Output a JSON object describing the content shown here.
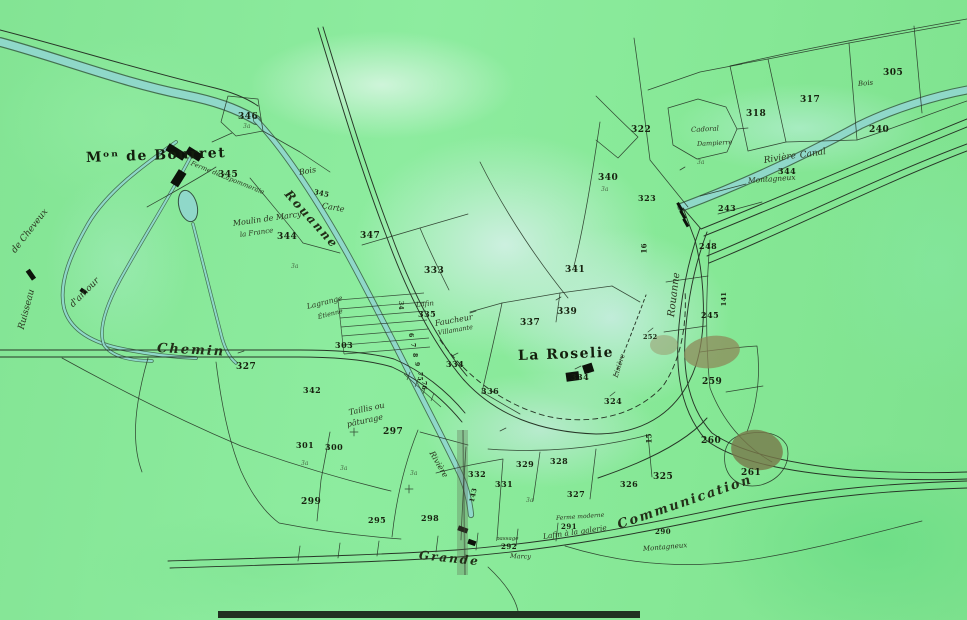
{
  "palette": {
    "paper_green": "#86e798",
    "wash_cyan": "#cfeee4",
    "river_teal": "#8fd8c9",
    "ink": "#273627",
    "building_black": "#0d120b",
    "smudge_brown": "#8d8758"
  },
  "labels": [
    {
      "t": "Mᵒⁿ de Bourret",
      "x": 86,
      "y": 151,
      "s": 14,
      "r": -2,
      "c": "t"
    },
    {
      "t": "La Roselie",
      "x": 518,
      "y": 349,
      "s": 14,
      "r": -2,
      "c": "t"
    },
    {
      "t": "Chemin",
      "x": 157,
      "y": 342,
      "s": 13,
      "r": 3,
      "c": "sl"
    },
    {
      "t": "Grande",
      "x": 419,
      "y": 549,
      "s": 12,
      "r": 6,
      "c": "sl"
    },
    {
      "t": "Communication",
      "x": 618,
      "y": 519,
      "s": 13,
      "r": -19,
      "c": "sl"
    },
    {
      "t": "Rouanne",
      "x": 287,
      "y": 186,
      "s": 12,
      "r": 48,
      "c": "sl"
    },
    {
      "t": "Rouanne",
      "x": 672,
      "y": 312,
      "s": 10,
      "r": -83,
      "c": "s"
    },
    {
      "t": "Rivière",
      "x": 764,
      "y": 157,
      "s": 9,
      "r": -9,
      "c": "s"
    },
    {
      "t": "Canal",
      "x": 800,
      "y": 152,
      "s": 9,
      "r": -9,
      "c": "s"
    },
    {
      "t": "Ruisseau",
      "x": 22,
      "y": 325,
      "s": 9,
      "r": -75,
      "c": "s"
    },
    {
      "t": "de Cheveux",
      "x": 14,
      "y": 248,
      "s": 9,
      "r": -52,
      "c": "s"
    },
    {
      "t": "d'amour",
      "x": 72,
      "y": 302,
      "s": 9,
      "r": -45,
      "c": "s"
    },
    {
      "t": "Bois",
      "x": 299,
      "y": 169,
      "s": 8,
      "r": -10,
      "c": "s"
    },
    {
      "t": "Bois",
      "x": 858,
      "y": 81,
      "s": 7,
      "r": -5,
      "c": "s"
    },
    {
      "t": "Moulin de Marcy",
      "x": 233,
      "y": 220,
      "s": 8,
      "r": -8,
      "c": "s"
    },
    {
      "t": "la France",
      "x": 240,
      "y": 232,
      "s": 7,
      "r": -8,
      "c": "s"
    },
    {
      "t": "Ferme de Lapommeraie",
      "x": 191,
      "y": 160,
      "s": 6.5,
      "r": 22,
      "c": "s"
    },
    {
      "t": "Carte",
      "x": 322,
      "y": 202,
      "s": 8,
      "r": 10,
      "c": "s"
    },
    {
      "t": "345",
      "x": 314,
      "y": 188,
      "s": 7,
      "r": 12,
      "c": "ns"
    },
    {
      "t": "Lagrange",
      "x": 307,
      "y": 303,
      "s": 7.5,
      "r": -14,
      "c": "s"
    },
    {
      "t": "Étienne",
      "x": 318,
      "y": 314,
      "s": 6.5,
      "r": -14,
      "c": "s"
    },
    {
      "t": "Faucheur",
      "x": 435,
      "y": 320,
      "s": 8,
      "r": -10,
      "c": "s"
    },
    {
      "t": "Villamante",
      "x": 438,
      "y": 330,
      "s": 6.5,
      "r": -10,
      "c": "s"
    },
    {
      "t": "Taillis ou",
      "x": 349,
      "y": 409,
      "s": 8,
      "r": -12,
      "c": "s"
    },
    {
      "t": "pâturage",
      "x": 347,
      "y": 421,
      "s": 8,
      "r": -12,
      "c": "s"
    },
    {
      "t": "Lafin",
      "x": 416,
      "y": 302,
      "s": 7,
      "r": -6,
      "c": "s"
    },
    {
      "t": "Lafin à la galerie",
      "x": 543,
      "y": 533,
      "s": 7.5,
      "r": -8,
      "c": "s"
    },
    {
      "t": "Ferme moderne",
      "x": 556,
      "y": 516,
      "s": 6,
      "r": -4,
      "c": "s"
    },
    {
      "t": "passage",
      "x": 496,
      "y": 537,
      "s": 5.5,
      "r": 0,
      "c": "s"
    },
    {
      "t": "Marcy",
      "x": 510,
      "y": 553,
      "s": 6.5,
      "r": 2,
      "c": "s"
    },
    {
      "t": "Montagneux",
      "x": 748,
      "y": 177,
      "s": 7.5,
      "r": -4,
      "c": "s"
    },
    {
      "t": "Montagneux",
      "x": 643,
      "y": 546,
      "s": 7,
      "r": -5,
      "c": "s"
    },
    {
      "t": "Cadoral",
      "x": 691,
      "y": 127,
      "s": 7,
      "r": -3,
      "c": "s"
    },
    {
      "t": "Dampierre",
      "x": 697,
      "y": 141,
      "s": 6.5,
      "r": -3,
      "c": "s"
    },
    {
      "t": "Lisière",
      "x": 616,
      "y": 374,
      "s": 7,
      "r": -72,
      "c": "s"
    },
    {
      "t": "Rivière",
      "x": 431,
      "y": 448,
      "s": 8,
      "r": 60,
      "c": "s"
    },
    {
      "t": "346",
      "x": 238,
      "y": 113,
      "s": 9,
      "r": 0,
      "c": "n"
    },
    {
      "t": "345",
      "x": 218,
      "y": 171,
      "s": 9,
      "r": 0,
      "c": "n"
    },
    {
      "t": "344",
      "x": 277,
      "y": 233,
      "s": 9,
      "r": 0,
      "c": "n"
    },
    {
      "t": "347",
      "x": 360,
      "y": 232,
      "s": 9,
      "r": 0,
      "c": "n"
    },
    {
      "t": "333",
      "x": 424,
      "y": 267,
      "s": 9,
      "r": 0,
      "c": "n"
    },
    {
      "t": "341",
      "x": 565,
      "y": 266,
      "s": 9,
      "r": 0,
      "c": "n"
    },
    {
      "t": "339",
      "x": 557,
      "y": 308,
      "s": 9,
      "r": 0,
      "c": "n"
    },
    {
      "t": "337",
      "x": 520,
      "y": 319,
      "s": 9,
      "r": 0,
      "c": "n"
    },
    {
      "t": "335",
      "x": 418,
      "y": 310,
      "s": 8,
      "r": 0,
      "c": "n"
    },
    {
      "t": "303",
      "x": 335,
      "y": 341,
      "s": 8,
      "r": 0,
      "c": "n"
    },
    {
      "t": "327",
      "x": 236,
      "y": 363,
      "s": 9,
      "r": 0,
      "c": "n"
    },
    {
      "t": "342",
      "x": 303,
      "y": 386,
      "s": 8,
      "r": 0,
      "c": "n"
    },
    {
      "t": "334",
      "x": 446,
      "y": 360,
      "s": 8,
      "r": 0,
      "c": "n"
    },
    {
      "t": "336",
      "x": 481,
      "y": 387,
      "s": 8,
      "r": 0,
      "c": "n"
    },
    {
      "t": "334",
      "x": 571,
      "y": 373,
      "s": 8,
      "r": 0,
      "c": "n"
    },
    {
      "t": "324",
      "x": 604,
      "y": 397,
      "s": 8,
      "r": 0,
      "c": "n"
    },
    {
      "t": "322",
      "x": 631,
      "y": 126,
      "s": 9,
      "r": 0,
      "c": "n"
    },
    {
      "t": "340",
      "x": 598,
      "y": 174,
      "s": 9,
      "r": 0,
      "c": "n"
    },
    {
      "t": "323",
      "x": 638,
      "y": 194,
      "s": 8,
      "r": 0,
      "c": "n"
    },
    {
      "t": "243",
      "x": 718,
      "y": 204,
      "s": 8,
      "r": 0,
      "c": "n"
    },
    {
      "t": "240",
      "x": 869,
      "y": 126,
      "s": 9,
      "r": 0,
      "c": "n"
    },
    {
      "t": "344",
      "x": 778,
      "y": 167,
      "s": 8,
      "r": 0,
      "c": "n"
    },
    {
      "t": "318",
      "x": 746,
      "y": 110,
      "s": 9,
      "r": 0,
      "c": "n"
    },
    {
      "t": "317",
      "x": 800,
      "y": 96,
      "s": 9,
      "r": 0,
      "c": "n"
    },
    {
      "t": "305",
      "x": 883,
      "y": 69,
      "s": 9,
      "r": 0,
      "c": "n"
    },
    {
      "t": "259",
      "x": 702,
      "y": 378,
      "s": 9,
      "r": 0,
      "c": "n"
    },
    {
      "t": "260",
      "x": 701,
      "y": 437,
      "s": 9,
      "r": 0,
      "c": "n"
    },
    {
      "t": "261",
      "x": 741,
      "y": 469,
      "s": 9,
      "r": 0,
      "c": "n"
    },
    {
      "t": "252",
      "x": 643,
      "y": 334,
      "s": 6.5,
      "r": 0,
      "c": "ns"
    },
    {
      "t": "325",
      "x": 653,
      "y": 473,
      "s": 9,
      "r": 0,
      "c": "n"
    },
    {
      "t": "326",
      "x": 620,
      "y": 480,
      "s": 8,
      "r": 0,
      "c": "n"
    },
    {
      "t": "327",
      "x": 567,
      "y": 490,
      "s": 8,
      "r": 0,
      "c": "n"
    },
    {
      "t": "329",
      "x": 516,
      "y": 460,
      "s": 8,
      "r": 0,
      "c": "n"
    },
    {
      "t": "328",
      "x": 550,
      "y": 457,
      "s": 8,
      "r": 0,
      "c": "n"
    },
    {
      "t": "331",
      "x": 495,
      "y": 480,
      "s": 8,
      "r": 0,
      "c": "n"
    },
    {
      "t": "332",
      "x": 468,
      "y": 470,
      "s": 8,
      "r": 0,
      "c": "n"
    },
    {
      "t": "297",
      "x": 383,
      "y": 428,
      "s": 9,
      "r": 0,
      "c": "n"
    },
    {
      "t": "300",
      "x": 325,
      "y": 443,
      "s": 8,
      "r": 0,
      "c": "n"
    },
    {
      "t": "301",
      "x": 296,
      "y": 441,
      "s": 8,
      "r": 0,
      "c": "n"
    },
    {
      "t": "299",
      "x": 301,
      "y": 498,
      "s": 9,
      "r": 0,
      "c": "n"
    },
    {
      "t": "295",
      "x": 368,
      "y": 516,
      "s": 8,
      "r": 0,
      "c": "n"
    },
    {
      "t": "298",
      "x": 421,
      "y": 514,
      "s": 8,
      "r": 0,
      "c": "n"
    },
    {
      "t": "292",
      "x": 501,
      "y": 543,
      "s": 7,
      "r": 0,
      "c": "n"
    },
    {
      "t": "291",
      "x": 561,
      "y": 523,
      "s": 7,
      "r": 0,
      "c": "n"
    },
    {
      "t": "290",
      "x": 655,
      "y": 528,
      "s": 7,
      "r": 0,
      "c": "n"
    },
    {
      "t": "248",
      "x": 699,
      "y": 242,
      "s": 8,
      "r": 0,
      "c": "n"
    },
    {
      "t": "245",
      "x": 701,
      "y": 311,
      "s": 8,
      "r": 0,
      "c": "n"
    },
    {
      "t": "16",
      "x": 644,
      "y": 250,
      "s": 7,
      "r": -90,
      "c": "ns"
    },
    {
      "t": "15",
      "x": 649,
      "y": 440,
      "s": 7,
      "r": -90,
      "c": "ns"
    },
    {
      "t": "141",
      "x": 724,
      "y": 303,
      "s": 6.5,
      "r": -90,
      "c": "ns"
    },
    {
      "t": "143",
      "x": 472,
      "y": 499,
      "s": 6.5,
      "r": -78,
      "c": "ns"
    },
    {
      "t": "34",
      "x": 400,
      "y": 298,
      "s": 6,
      "r": 90,
      "c": "ns"
    },
    {
      "t": "6",
      "x": 410,
      "y": 330,
      "s": 6,
      "r": 90,
      "c": "ns"
    },
    {
      "t": "7",
      "x": 412,
      "y": 340,
      "s": 6,
      "r": 90,
      "c": "ns"
    },
    {
      "t": "8",
      "x": 414,
      "y": 350,
      "s": 6,
      "r": 90,
      "c": "ns"
    },
    {
      "t": "9",
      "x": 416,
      "y": 359,
      "s": 6,
      "r": 90,
      "c": "ns"
    },
    {
      "t": "75",
      "x": 419,
      "y": 369,
      "s": 6,
      "r": 90,
      "c": "ns"
    },
    {
      "t": "76",
      "x": 423,
      "y": 378,
      "s": 6,
      "r": 90,
      "c": "ns"
    },
    {
      "t": "3a",
      "x": 243,
      "y": 124,
      "s": 6,
      "r": 0,
      "c": "a"
    },
    {
      "t": "3a",
      "x": 291,
      "y": 264,
      "s": 6,
      "r": 0,
      "c": "a"
    },
    {
      "t": "3a",
      "x": 601,
      "y": 187,
      "s": 6,
      "r": 0,
      "c": "a"
    },
    {
      "t": "3a",
      "x": 697,
      "y": 160,
      "s": 6,
      "r": 0,
      "c": "a"
    },
    {
      "t": "3a",
      "x": 410,
      "y": 471,
      "s": 6,
      "r": 0,
      "c": "a"
    },
    {
      "t": "3a",
      "x": 340,
      "y": 466,
      "s": 6,
      "r": 0,
      "c": "a"
    },
    {
      "t": "3a",
      "x": 526,
      "y": 498,
      "s": 6,
      "r": 0,
      "c": "a"
    },
    {
      "t": "3a",
      "x": 301,
      "y": 461,
      "s": 6,
      "r": 0,
      "c": "a"
    }
  ]
}
